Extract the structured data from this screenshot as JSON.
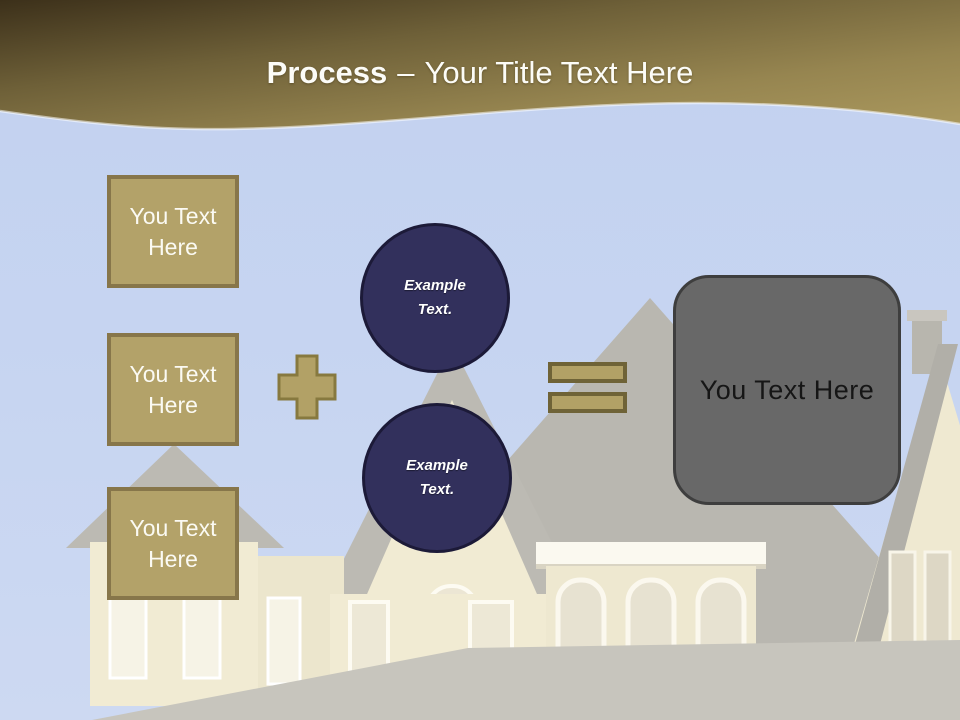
{
  "slide": {
    "header": {
      "title_bold": "Process",
      "title_separator": "–",
      "title_rest": "Your Title Text Here"
    },
    "input_boxes": [
      {
        "label": "You Text Here"
      },
      {
        "label": "You Text Here"
      },
      {
        "label": "You Text Here"
      }
    ],
    "operators": {
      "plus": "plus-icon",
      "equals": "equals-icon"
    },
    "example_circles": [
      {
        "label": "Example Text."
      },
      {
        "label": "Example Text."
      }
    ],
    "result_box": {
      "label": "You Text Here"
    },
    "colors": {
      "gold_fill": "#b3a269",
      "gold_border": "#87764a",
      "navy_fill": "#32305c",
      "navy_border": "#1c1a38",
      "gray_fill": "#686868",
      "gray_border": "#3e3e3e",
      "band_dark": "#3c301a",
      "band_light": "#ab995e",
      "sky": "#c7d5f1",
      "title_text": "#fcfcf7"
    }
  }
}
